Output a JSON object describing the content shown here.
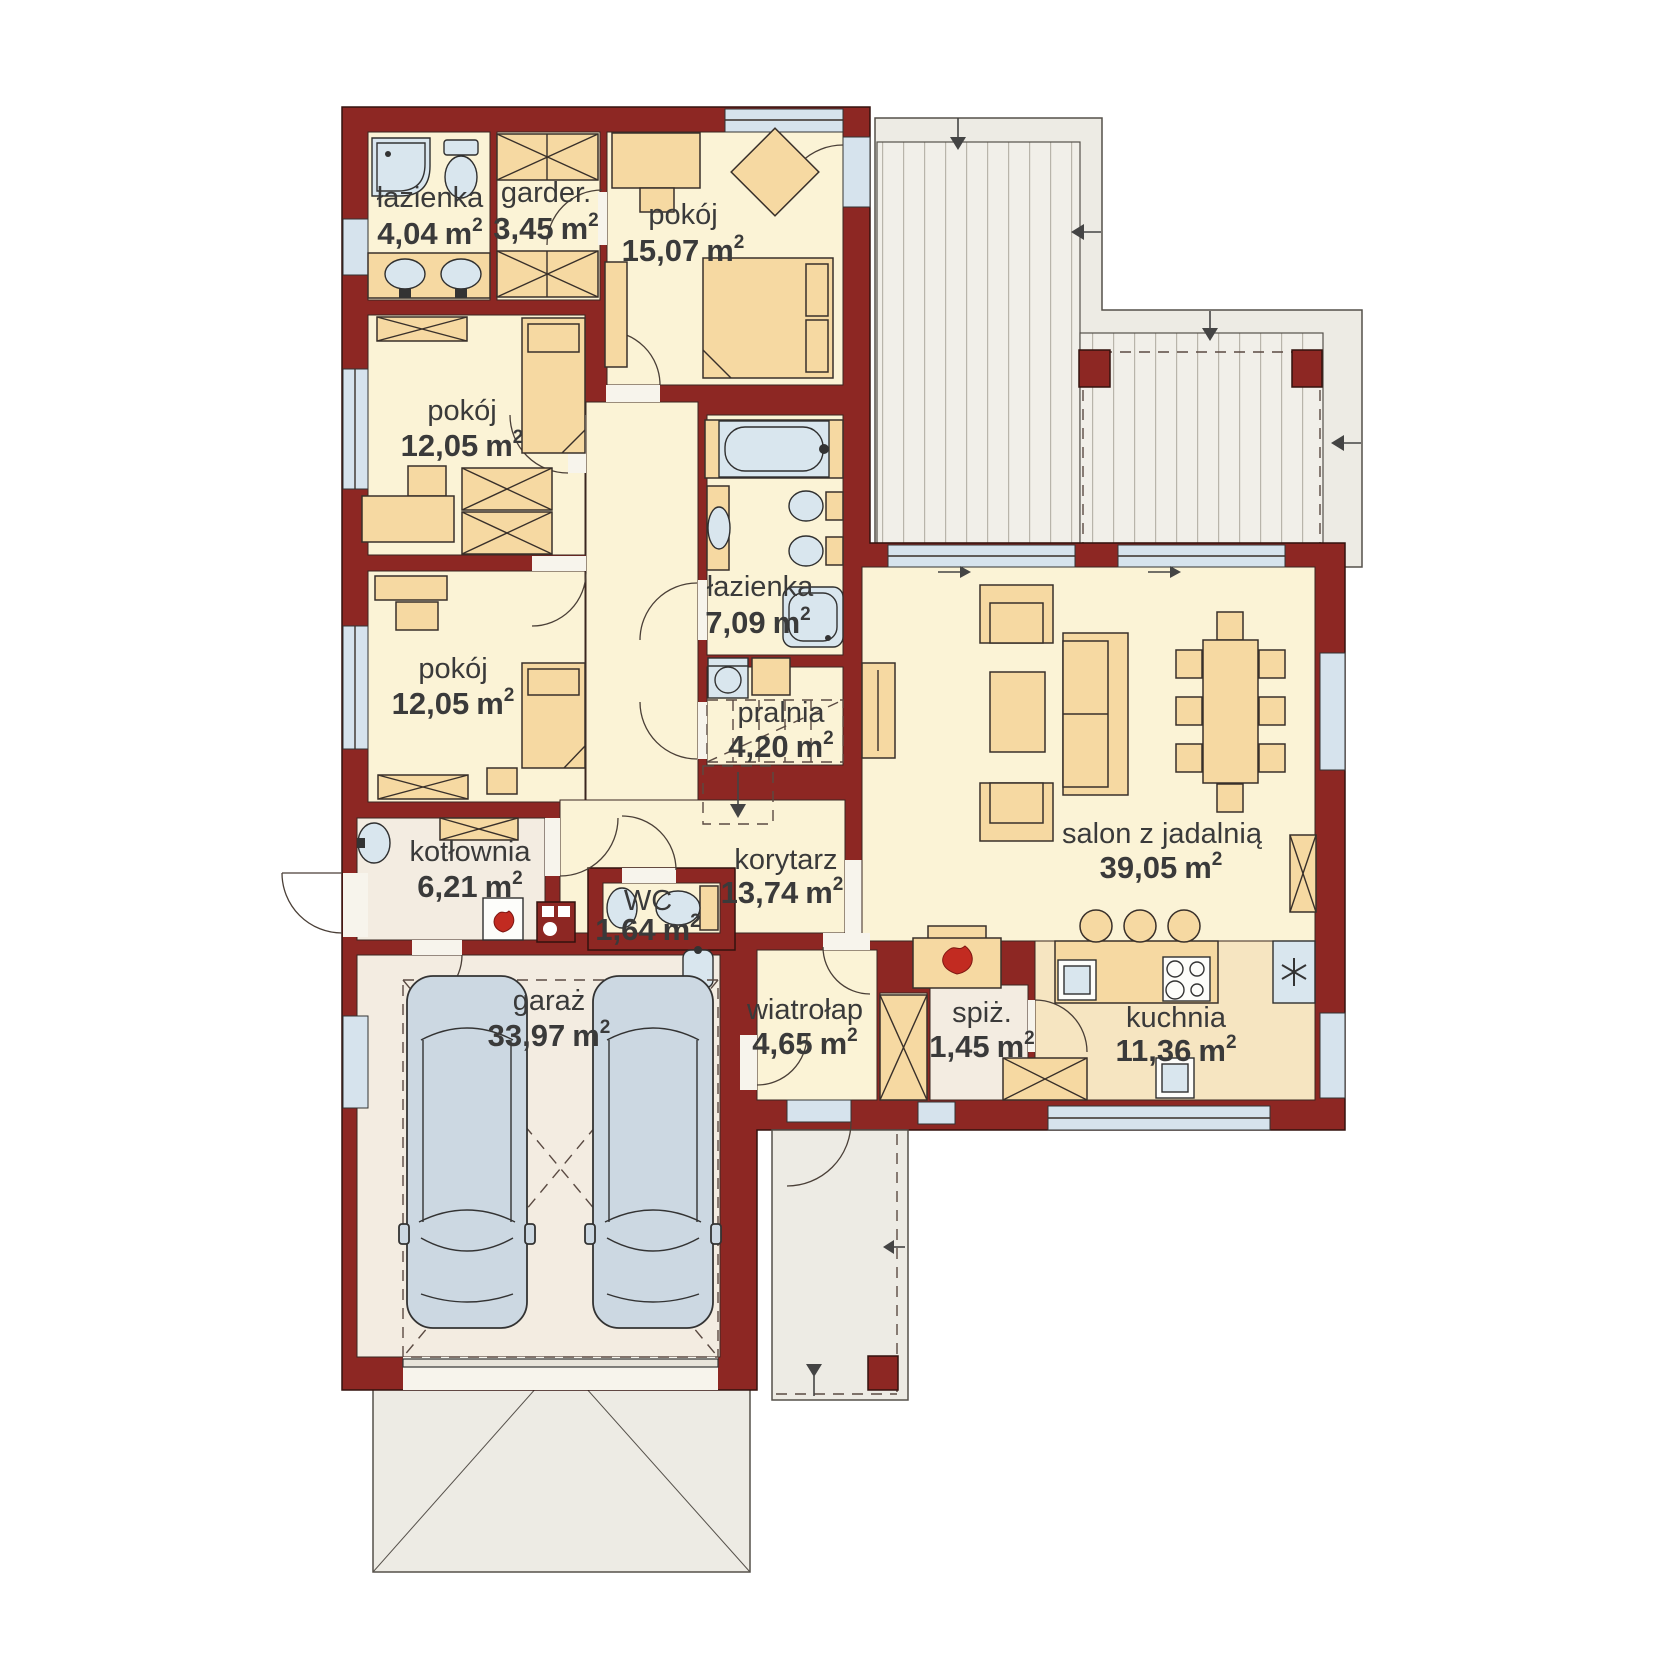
{
  "floorplan": {
    "units": {
      "base": "m",
      "sup": "2"
    },
    "colors": {
      "wall": "#8d2723",
      "room_floor": "#fbf3d6",
      "tech_floor": "#f3ece1",
      "kitchen_floor": "#f6e5c1",
      "furniture": "#f6d9a2",
      "fixture": "#d9e6ee",
      "terrace": "#edebe4",
      "flame_accent": "#c22b21",
      "text": "#3a3a3a"
    },
    "rooms": [
      {
        "name": "łazienka",
        "area": "4,04"
      },
      {
        "name": "garder.",
        "area": "3,45"
      },
      {
        "name": "pokój",
        "area": "15,07"
      },
      {
        "name": "pokój",
        "area": "12,05"
      },
      {
        "name": "pokój",
        "area": "12,05"
      },
      {
        "name": "łazienka",
        "area": "7,09"
      },
      {
        "name": "pralnia",
        "area": "4,20"
      },
      {
        "name": "korytarz",
        "area": "13,74"
      },
      {
        "name": "WC",
        "area": "1,64"
      },
      {
        "name": "kotłownia",
        "area": "6,21"
      },
      {
        "name": "garaż",
        "area": "33,97"
      },
      {
        "name": "wiatrołap",
        "area": "4,65"
      },
      {
        "name": "spiż.",
        "area": "1,45"
      },
      {
        "name": "kuchnia",
        "area": "11,36"
      },
      {
        "name": "salon z jadalnią",
        "area": "39,05"
      }
    ]
  }
}
